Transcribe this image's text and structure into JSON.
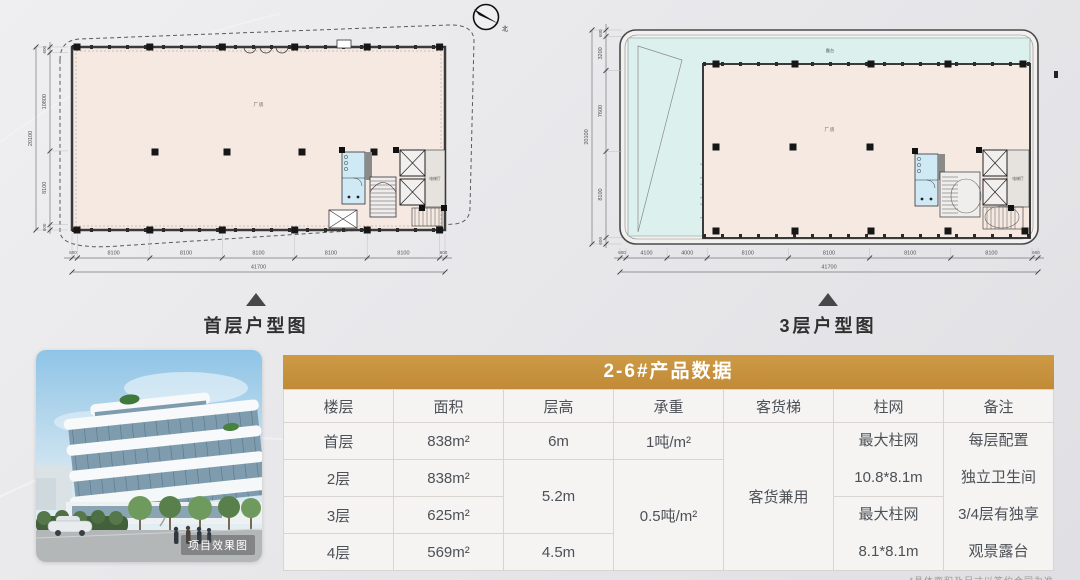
{
  "compass": {
    "north_label": "北"
  },
  "colors": {
    "accent_gold": "#c18a37",
    "plan_fill": "#f6e9e2",
    "terrace_fill": "#dcf0ee",
    "toilet_fill": "#cfe9f5"
  },
  "plans": {
    "first_floor": {
      "caption": "首层户型图",
      "area_label": "厂房",
      "lobby_label": "电梯厅",
      "dims_bottom": [
        "600",
        "8100",
        "8100",
        "8100",
        "8100",
        "8100",
        "600"
      ],
      "dims_bottom_total": "41700",
      "dims_left": [
        "600",
        "10800",
        "8100",
        "600"
      ],
      "dims_left_total": "20100"
    },
    "third_floor": {
      "caption": "3层户型图",
      "area_label": "厂房",
      "terrace_label": "露台",
      "lobby_label": "电梯厅",
      "dims_bottom": [
        "600",
        "4100",
        "4000",
        "8100",
        "8100",
        "8100",
        "8100",
        "600"
      ],
      "dims_bottom_total": "41700",
      "dims_left": [
        "600",
        "3200",
        "7600",
        "8100",
        "600"
      ],
      "dims_left_total": "20100"
    }
  },
  "photo": {
    "caption": "项目效果图"
  },
  "table": {
    "title": "2-6#产品数据",
    "columns": [
      "楼层",
      "面积",
      "层高",
      "承重",
      "客货梯",
      "柱网",
      "备注"
    ],
    "floors": [
      {
        "name": "首层",
        "area": "838m²"
      },
      {
        "name": "2层",
        "area": "838m²"
      },
      {
        "name": "3层",
        "area": "625m²"
      },
      {
        "name": "4层",
        "area": "569m²"
      }
    ],
    "heights": {
      "floor1": "6m",
      "floor2_3": "5.2m",
      "floor4": "4.5m"
    },
    "loads": {
      "floor1": "1吨/m²",
      "floor2_4": "0.5吨/m²"
    },
    "elevator": "客货兼用",
    "pillar_upper": {
      "line1": "最大柱网",
      "line2": "10.8*8.1m"
    },
    "pillar_lower": {
      "line1": "最大柱网",
      "line2": "8.1*8.1m"
    },
    "notes": [
      "每层配置",
      "独立卫生间",
      "3/4层有独享",
      "观景露台"
    ],
    "footnote": "*具体面积及尺寸以签约合同为准"
  }
}
